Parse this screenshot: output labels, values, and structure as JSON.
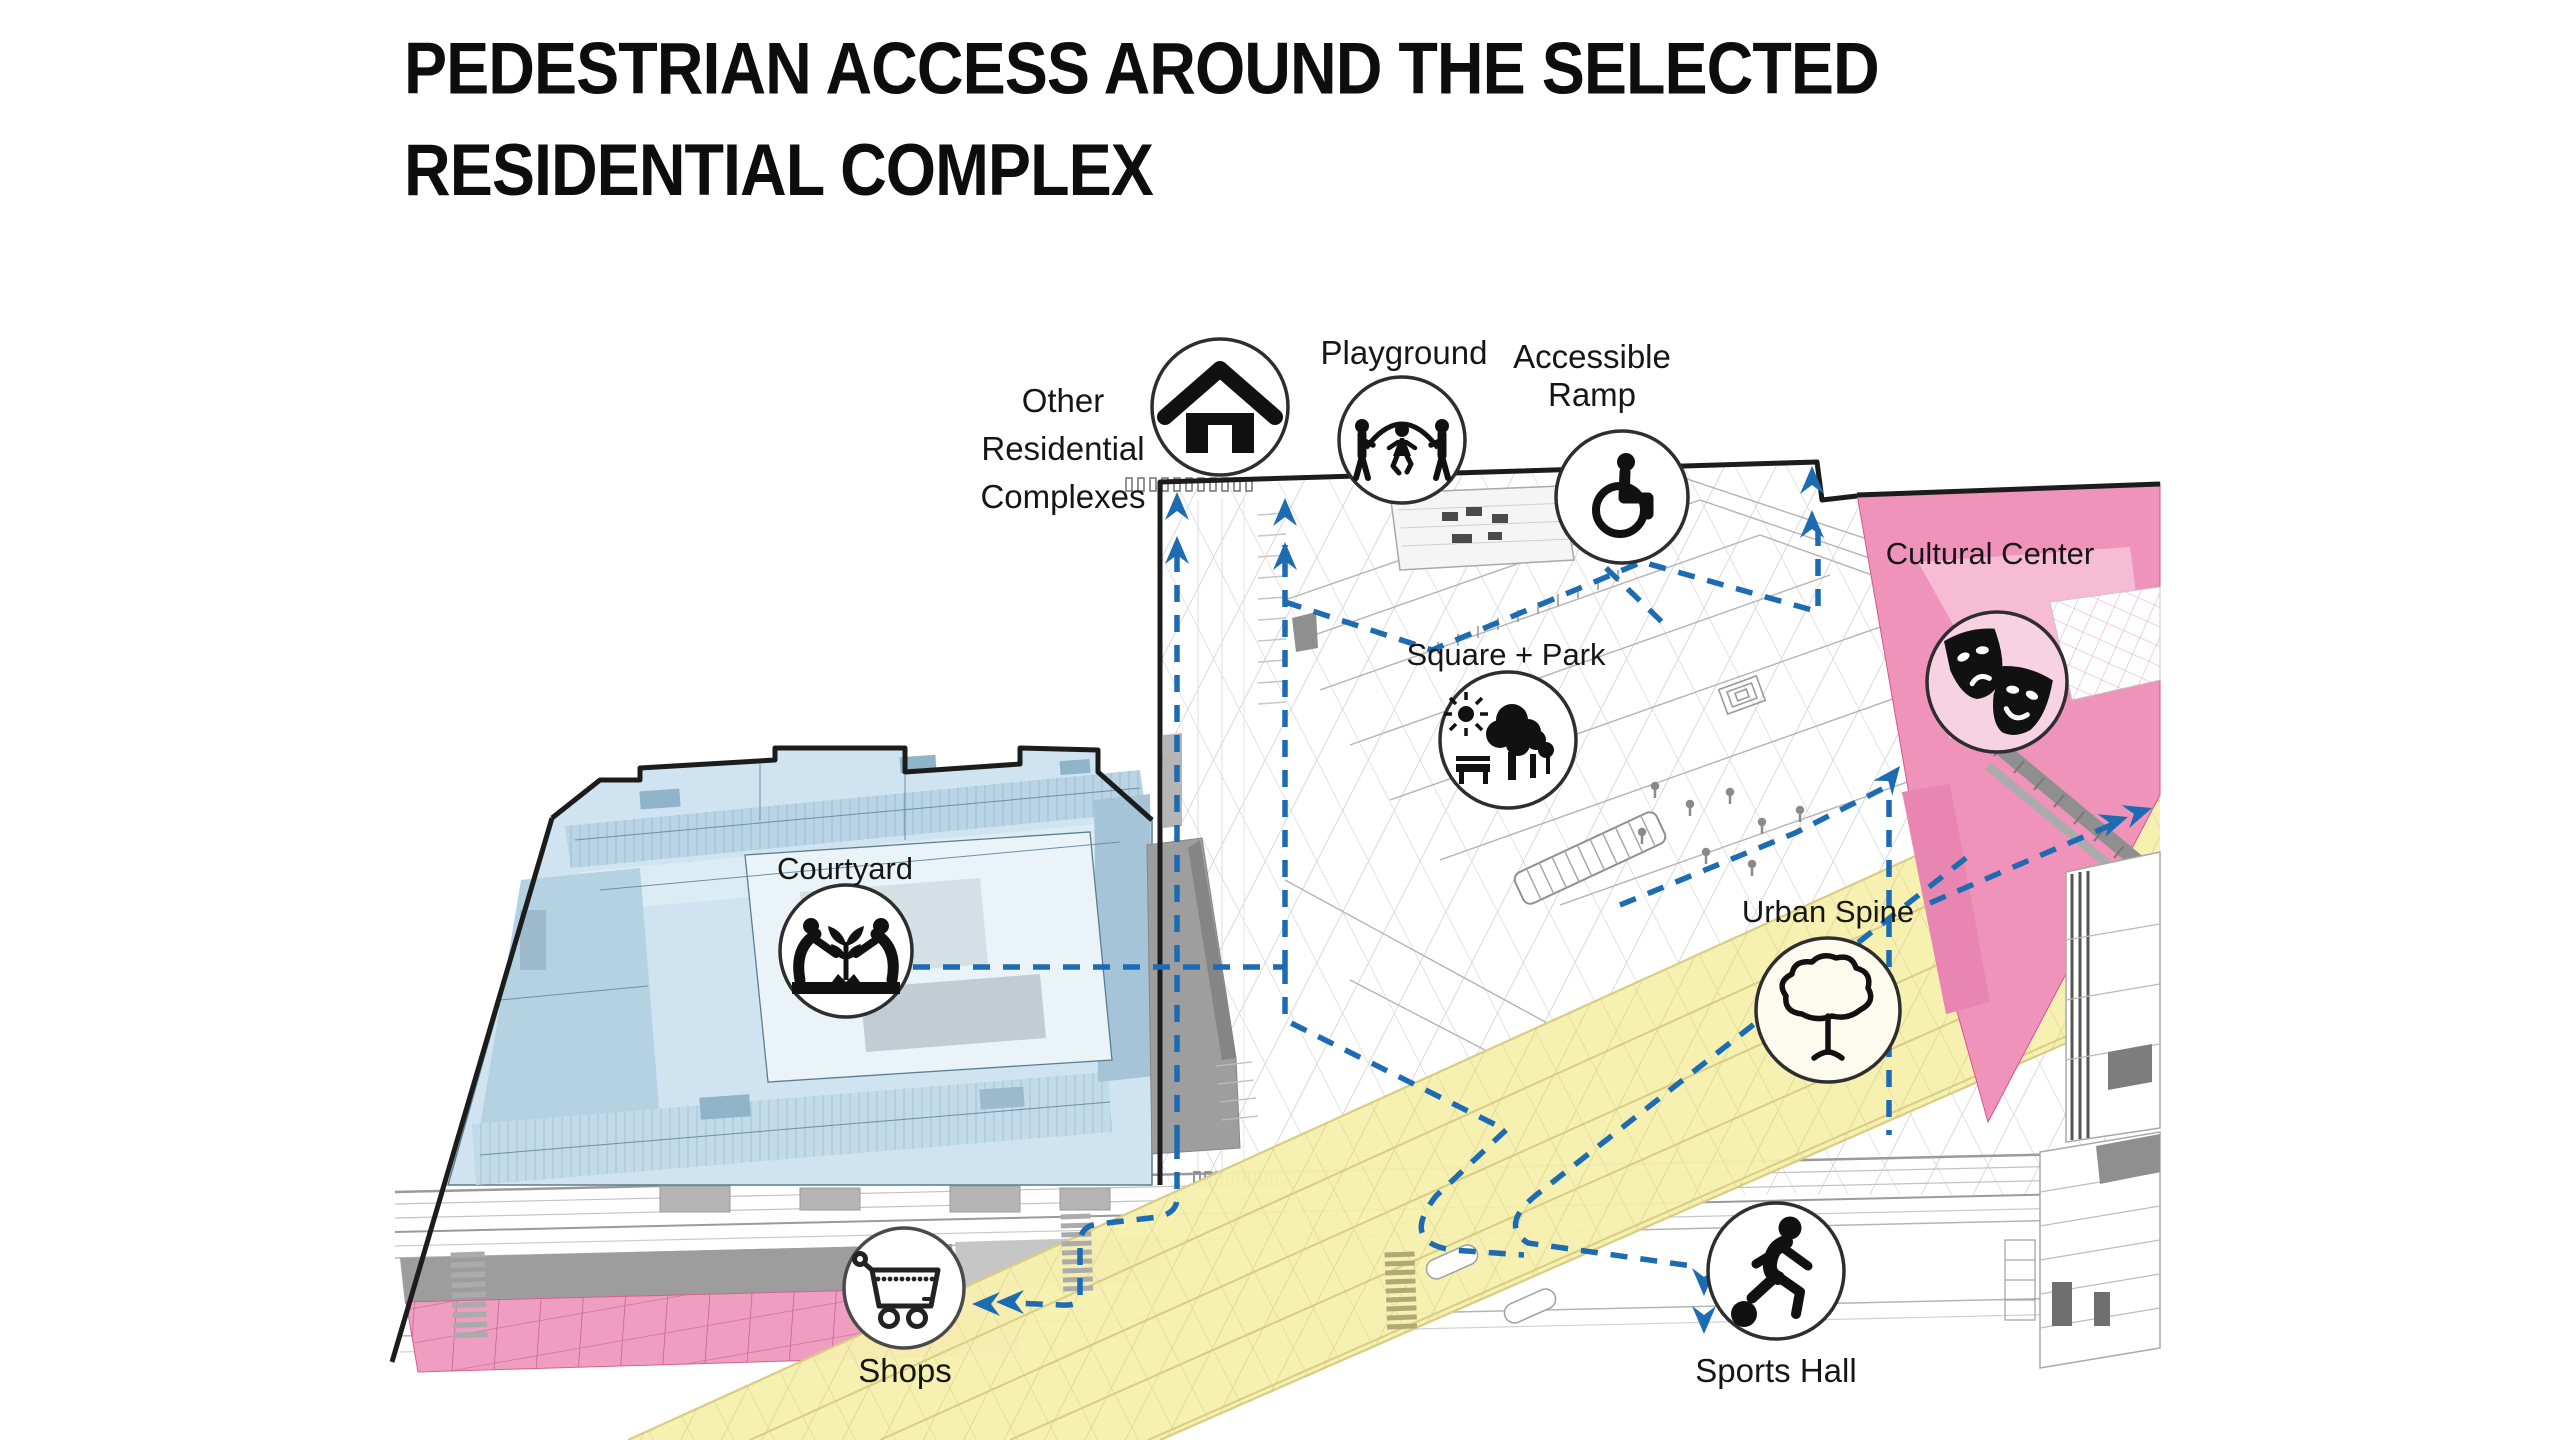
{
  "title": {
    "line1": "PEDESTRIAN ACCESS AROUND THE SELECTED",
    "line2": "RESIDENTIAL COMPLEX"
  },
  "annotations": [
    {
      "id": "other-residential-complexes",
      "lines": [
        "Other",
        "Residential",
        "Complexes"
      ],
      "icon": "house-icon"
    },
    {
      "id": "playground",
      "lines": [
        "Playground"
      ],
      "icon": "children-jump-rope-icon"
    },
    {
      "id": "accessible-ramp",
      "lines": [
        "Accessible",
        "Ramp"
      ],
      "icon": "wheelchair-icon"
    },
    {
      "id": "cultural-center",
      "lines": [
        "Cultural Center"
      ],
      "icon": "theater-masks-icon"
    },
    {
      "id": "square-park",
      "lines": [
        "Square + Park"
      ],
      "icon": "park-trees-bench-icon"
    },
    {
      "id": "courtyard",
      "lines": [
        "Courtyard"
      ],
      "icon": "people-planting-icon"
    },
    {
      "id": "urban-spine",
      "lines": [
        "Urban Spine"
      ],
      "icon": "tree-outline-icon"
    },
    {
      "id": "shops",
      "lines": [
        "Shops"
      ],
      "icon": "shopping-cart-icon"
    },
    {
      "id": "sports-hall",
      "lines": [
        "Sports Hall"
      ],
      "icon": "soccer-player-icon"
    }
  ],
  "colors": {
    "pedestrian_route": "#1c6bb3",
    "residential_complex_fill": "#cfe4f0",
    "cultural_center_fill": "#ef93bb",
    "shops_fill": "#ef9ec1",
    "urban_spine_fill": "#f6efae",
    "background": "#ffffff"
  }
}
